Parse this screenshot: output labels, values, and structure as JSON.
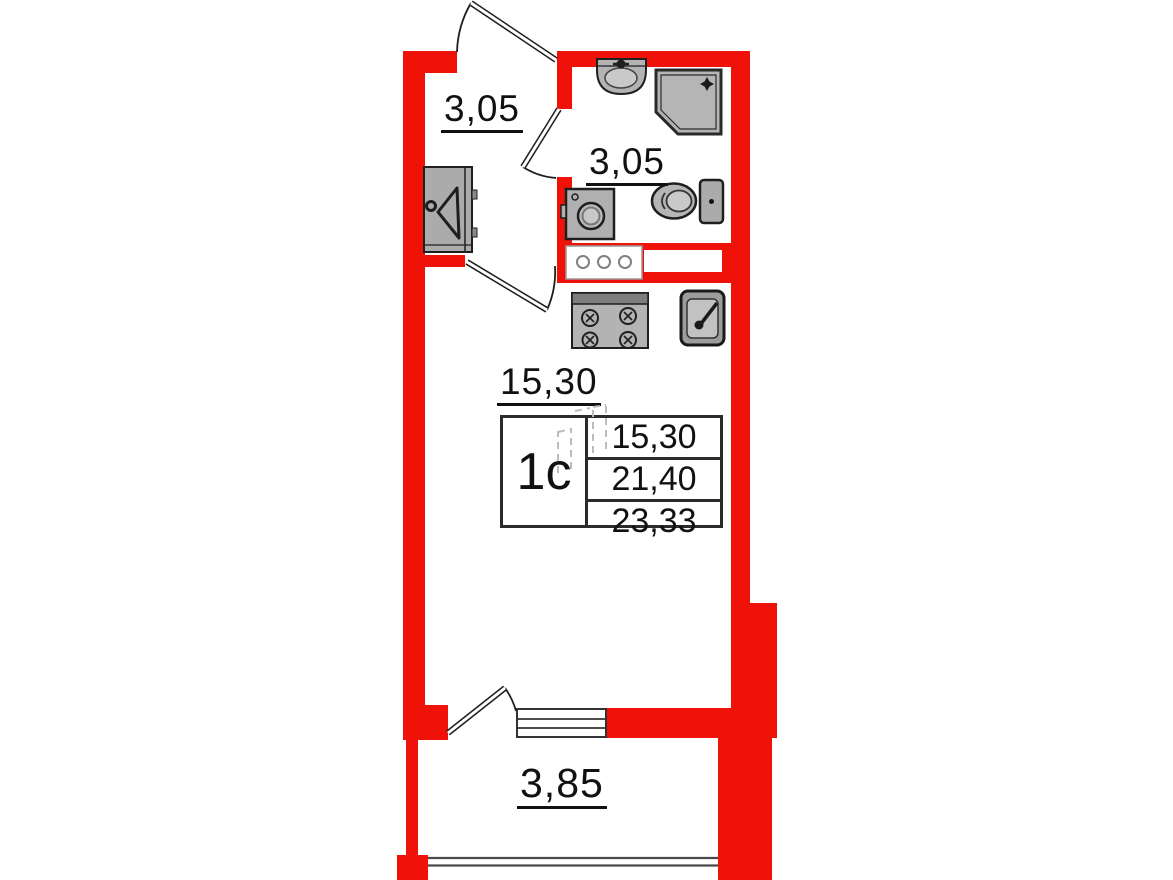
{
  "plan_title": "studio apartment floor plan",
  "unit": {
    "type_label": "1с",
    "table_rows": [
      "15,30",
      "21,40",
      "23,33"
    ]
  },
  "rooms": {
    "hallway": {
      "label": "3,05"
    },
    "bathroom": {
      "label": "3,05"
    },
    "living_room": {
      "label": "15,30"
    },
    "balcony": {
      "label": "3,85"
    }
  },
  "colors": {
    "wall": "#ee1208",
    "fixture_fill": "#b3b3b3",
    "outline": "#1f1f1f",
    "text": "#111111"
  },
  "fixtures": [
    "wardrobe-icon",
    "washbasin-icon",
    "shower-icon",
    "washing-machine-icon",
    "toilet-icon",
    "vent-shaft-icon",
    "stove-icon",
    "kitchen-sink-icon",
    "entrance-door-icon",
    "bathroom-door-icon",
    "room-door-icon",
    "balcony-door-icon",
    "balcony-window-icon",
    "balcony-glazing-icon"
  ]
}
